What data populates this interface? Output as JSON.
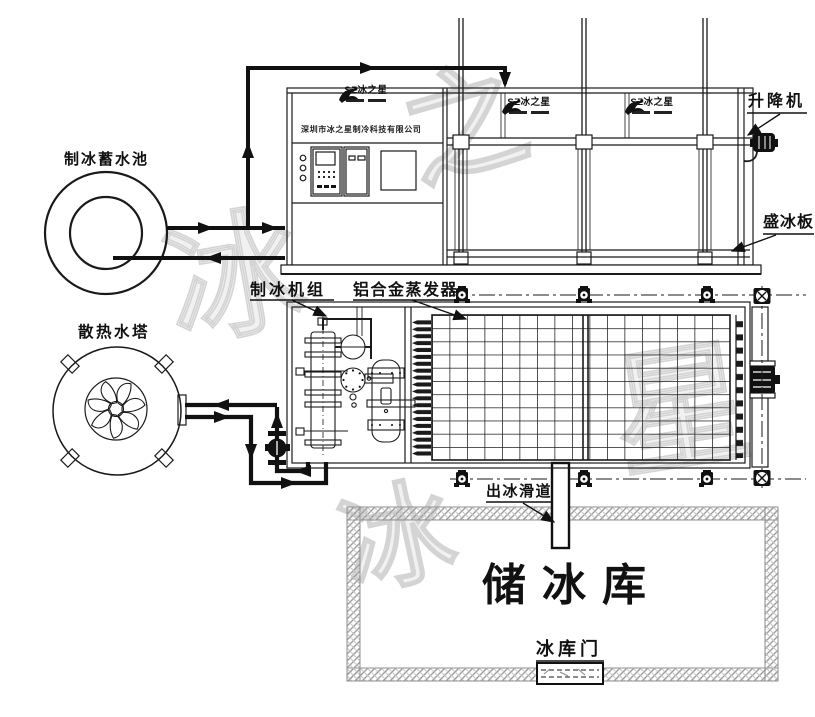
{
  "diagram": {
    "labels": {
      "pool": "制冰蓄水池",
      "cooling_tower": "散热水塔",
      "ice_unit": "制冰机组",
      "evaporator": "铝合金蒸发器",
      "lift": "升降机",
      "ice_plate": "盛冰板",
      "ice_chute": "出冰滑道",
      "ice_storage": "储冰库",
      "storage_door": "冰库门"
    },
    "brand": {
      "logo_text": "SZ冰之星",
      "company": "深圳市冰之星制冷科技有限公司"
    },
    "watermarks": [
      "冰",
      "之",
      "星",
      "冰"
    ],
    "colors": {
      "line": "#1a1a1a",
      "watermark": "#d4d4d4",
      "wall": "#a8a8a8"
    }
  }
}
